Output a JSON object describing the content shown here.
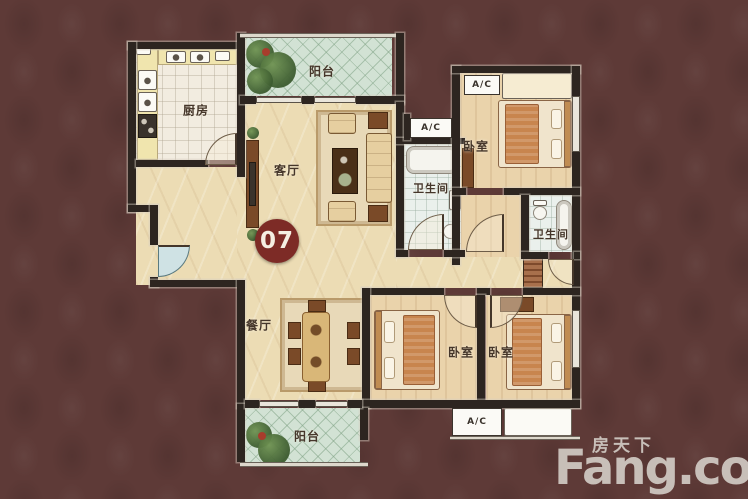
{
  "unit": {
    "number": "07"
  },
  "rooms": {
    "kitchen": "厨房",
    "balcony_top": "阳台",
    "living": "客厅",
    "bedroom_top_right": "卧室",
    "bath_middle": "卫生间",
    "bath_right": "卫生间",
    "dining": "餐厅",
    "bedroom_bottom_middle": "卧室",
    "bedroom_bottom_right": "卧室",
    "balcony_bottom": "阳台"
  },
  "equipment": {
    "ac_top": "A/C",
    "ac_middle": "A/C",
    "ac_bottom": "A/C"
  },
  "watermark": {
    "cn": "房天下",
    "en": "Fang.com"
  },
  "colors": {
    "background": "#5e3a37",
    "wall": "#2d2520",
    "floor_marble": "#ecdcb4",
    "floor_wood": "#ead3ab",
    "balcony": "#d2e2d4",
    "badge": "#7d2b26",
    "watermark": "#ccc5bf"
  }
}
